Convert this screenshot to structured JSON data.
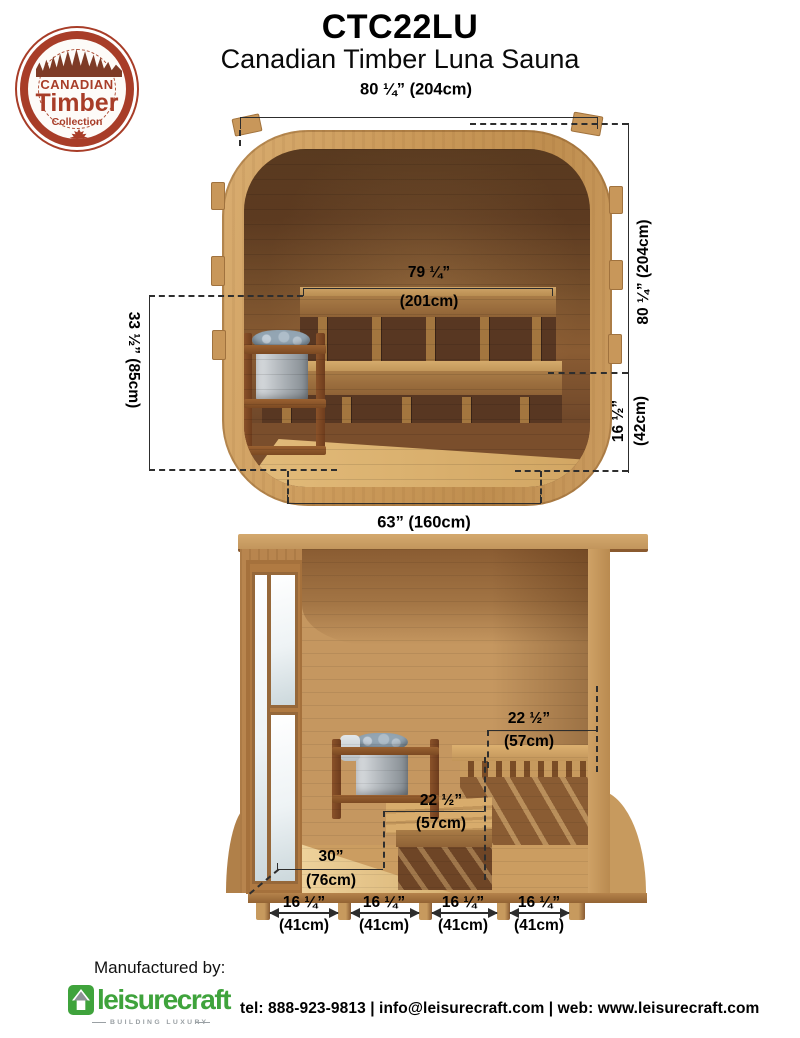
{
  "header": {
    "model": "CTC22LU",
    "product_name": "Canadian Timber Luna Sauna"
  },
  "badge": {
    "top": "CANADIAN",
    "middle": "Timber",
    "bottom": "Collection"
  },
  "front_view": {
    "overall_width": "80 ¼” (204cm)",
    "overall_height": "80 ¼” (204cm)",
    "interior_width_in": "79 ¼”",
    "interior_width_cm": "(201cm)",
    "upper_bench_height": "33 ½” (85cm)",
    "lower_bench_height_in": "16 ½”",
    "lower_bench_height_cm": "(42cm)",
    "base_width": "63” (160cm)"
  },
  "side_view": {
    "upper_bench_depth_in": "22 ½”",
    "upper_bench_depth_cm": "(57cm)",
    "lower_bench_depth_in": "22 ½”",
    "lower_bench_depth_cm": "(57cm)",
    "floor_depth_in": "30”",
    "floor_depth_cm": "(76cm)",
    "joist_spacings": [
      {
        "in": "16 ¼”",
        "cm": "(41cm)"
      },
      {
        "in": "16 ¼”",
        "cm": "(41cm)"
      },
      {
        "in": "16 ¼”",
        "cm": "(41cm)"
      },
      {
        "in": "16 ¼”",
        "cm": "(41cm)"
      }
    ]
  },
  "footer": {
    "manufactured_by": "Manufactured by:",
    "brand": "leisurecraft",
    "tagline": "BUILDING LUXURY",
    "contact": "tel: 888-923-9813 | info@leisurecraft.com | web: www.leisurecraft.com"
  },
  "colors": {
    "badge_red": "#a83d28",
    "brand_green": "#3fa33c",
    "dim_line": "#2d2d2d",
    "wood_light": "#d2a165",
    "wood_dark": "#6b4527"
  }
}
